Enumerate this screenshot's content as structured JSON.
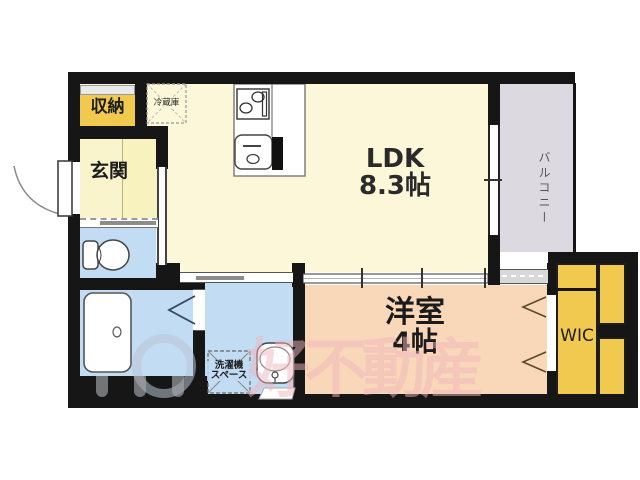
{
  "rooms": {
    "ldk": {
      "name": "LDK",
      "size": "8.3帖"
    },
    "youshitsu": {
      "name": "洋室",
      "size": "4帖"
    },
    "genkan": {
      "label": "玄関"
    },
    "shunou": {
      "label": "収納"
    },
    "wic": {
      "label": "WIC"
    },
    "balcony": {
      "label": "バルコニー"
    },
    "refrigerator": {
      "label": "冷蔵庫"
    },
    "laundry": {
      "line1": "洗濯機",
      "line2": "スペース"
    }
  },
  "watermark": {
    "text": "好不動産"
  },
  "colors": {
    "wall": "#161616",
    "ldk_floor": "#FBF7D8",
    "western_room": "#F9D8B9",
    "wet_area": "#C2DCF4",
    "storage_yellow": "#F2C94F",
    "balcony_gray": "#DCDAE0"
  }
}
